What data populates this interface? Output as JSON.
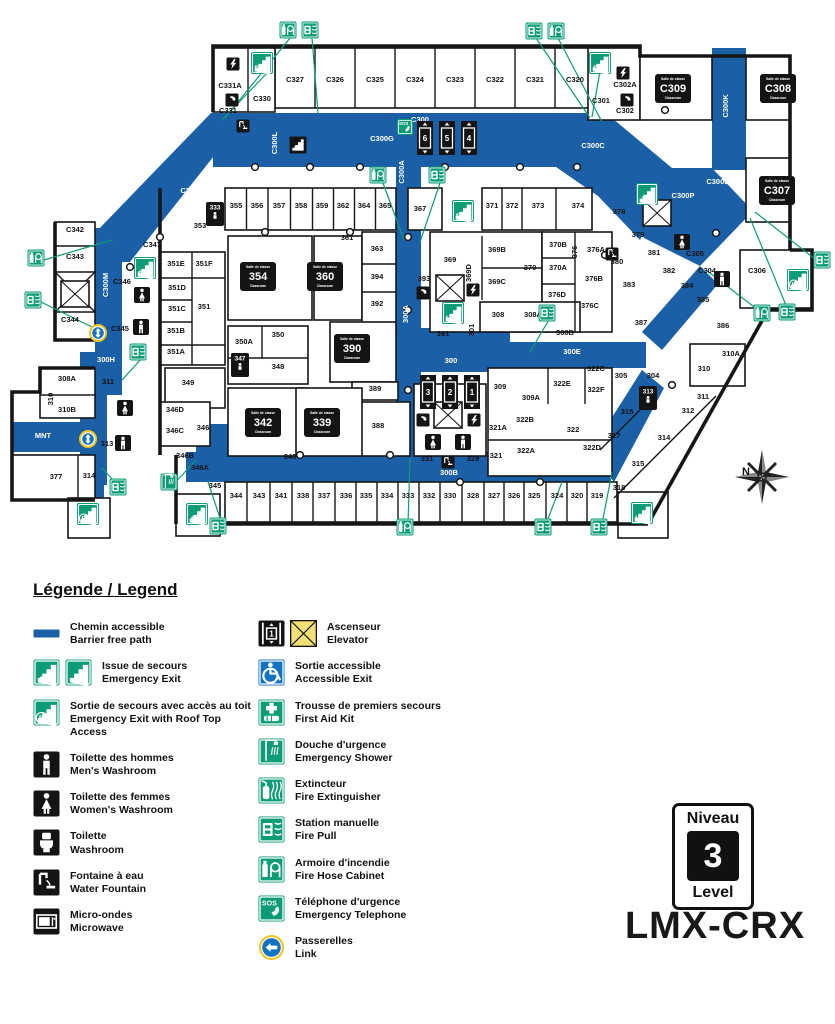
{
  "page": {
    "background": "#ffffff"
  },
  "colors": {
    "path_blue": "#1b5fa6",
    "sign_green": "#0c9c77",
    "sign_black": "#141414",
    "elevator_yellow": "#f3e176",
    "link_ring_yellow": "#f2c31c",
    "accessible_blue": "#1273c0",
    "wall": "#161616"
  },
  "building_code": "LMX-CRX",
  "level_badge": {
    "top": "Niveau",
    "number": "3",
    "bottom": "Level"
  },
  "compass_label": "N",
  "legend": {
    "title": "Légende / Legend",
    "left": [
      {
        "icon": "barrier-path",
        "fr": "Chemin accessible",
        "en": "Barrier free path"
      },
      {
        "icon": "emergency-exit",
        "fr": "Issue de secours",
        "en": "Emergency Exit"
      },
      {
        "icon": "emergency-exit-roof",
        "fr": "Sortie de secours avec accès au toit",
        "en": "Emergency Exit with Roof Top Access"
      },
      {
        "icon": "mens-washroom",
        "fr": "Toilette des hommes",
        "en": "Men's Washroom"
      },
      {
        "icon": "womens-washroom",
        "fr": "Toilette des femmes",
        "en": "Women's Washroom"
      },
      {
        "icon": "washroom",
        "fr": "Toilette",
        "en": "Washroom"
      },
      {
        "icon": "water-fountain",
        "fr": "Fontaine à eau",
        "en": "Water Fountain"
      },
      {
        "icon": "microwave",
        "fr": "Micro-ondes",
        "en": "Microwave"
      }
    ],
    "right": [
      {
        "icon": "elevator",
        "fr": "Ascenseur",
        "en": "Elevator"
      },
      {
        "icon": "accessible-exit",
        "fr": "Sortie accessible",
        "en": "Accessible Exit"
      },
      {
        "icon": "first-aid",
        "fr": "Trousse de premiers secours",
        "en": "First Aid Kit"
      },
      {
        "icon": "emergency-shower",
        "fr": "Douche d'urgence",
        "en": "Emergency Shower"
      },
      {
        "icon": "fire-extinguisher",
        "fr": "Extincteur",
        "en": "Fire Extinguisher"
      },
      {
        "icon": "fire-pull",
        "fr": "Station manuelle",
        "en": "Fire Pull"
      },
      {
        "icon": "fire-hose",
        "fr": "Armoire d'incendie",
        "en": "Fire Hose Cabinet"
      },
      {
        "icon": "emergency-telephone",
        "fr": "Téléphone d'urgence",
        "en": "Emergency Telephone"
      },
      {
        "icon": "link",
        "fr": "Passerelles",
        "en": "Link"
      }
    ]
  },
  "map": {
    "corridor_labels": [
      [
        "C300",
        420,
        122,
        "h"
      ],
      [
        "C300A",
        404,
        172,
        "v"
      ],
      [
        "C300B",
        718,
        184,
        "h"
      ],
      [
        "C300C",
        593,
        148,
        "h"
      ],
      [
        "C300G",
        382,
        141,
        "h"
      ],
      [
        "C300H",
        243,
        178,
        "h"
      ],
      [
        "C300K",
        728,
        106,
        "v"
      ],
      [
        "C300L",
        277,
        143,
        "v"
      ],
      [
        "C300M",
        108,
        285,
        "v"
      ],
      [
        "C300N",
        192,
        193,
        "h"
      ],
      [
        "C300P",
        683,
        198,
        "h"
      ],
      [
        "300A",
        408,
        314,
        "v"
      ],
      [
        "300",
        451,
        363,
        "h"
      ],
      [
        "300B",
        449,
        475,
        "h"
      ],
      [
        "300E",
        572,
        354,
        "h"
      ],
      [
        "300F",
        689,
        334,
        "h"
      ],
      [
        "300G",
        577,
        472,
        "h"
      ],
      [
        "300H",
        106,
        362,
        "h"
      ],
      [
        "300J",
        477,
        208,
        "v"
      ],
      [
        "304A",
        92,
        404,
        "v"
      ],
      [
        "MNT",
        43,
        438,
        "h"
      ]
    ],
    "rooms": [
      [
        "C331A",
        230,
        88
      ],
      [
        "C330",
        262,
        101
      ],
      [
        "C331",
        228,
        113
      ],
      [
        "C327",
        295,
        82
      ],
      [
        "C326",
        335,
        82
      ],
      [
        "C325",
        375,
        82
      ],
      [
        "C324",
        415,
        82
      ],
      [
        "C323",
        455,
        82
      ],
      [
        "C322",
        495,
        82
      ],
      [
        "C321",
        535,
        82
      ],
      [
        "C320",
        575,
        82
      ],
      [
        "C301",
        601,
        103
      ],
      [
        "C302A",
        625,
        87
      ],
      [
        "C302",
        625,
        113
      ],
      [
        "C342",
        75,
        232
      ],
      [
        "C343",
        75,
        259
      ],
      [
        "C344",
        70,
        322
      ],
      [
        "C347",
        152,
        247
      ],
      [
        "C346",
        122,
        284
      ],
      [
        "C345",
        120,
        331
      ],
      [
        "355",
        236,
        208
      ],
      [
        "356",
        257,
        208
      ],
      [
        "357",
        279,
        208
      ],
      [
        "358",
        301,
        208
      ],
      [
        "359",
        322,
        208
      ],
      [
        "362",
        343,
        208
      ],
      [
        "364",
        364,
        208
      ],
      [
        "365",
        385,
        208
      ],
      [
        "353",
        200,
        228
      ],
      [
        "367",
        420,
        211
      ],
      [
        "371",
        492,
        208
      ],
      [
        "372",
        512,
        208
      ],
      [
        "373",
        538,
        208
      ],
      [
        "374",
        578,
        208
      ],
      [
        "351E",
        176,
        266
      ],
      [
        "351F",
        204,
        266
      ],
      [
        "351D",
        177,
        290
      ],
      [
        "351C",
        177,
        311
      ],
      [
        "351B",
        176,
        333
      ],
      [
        "351A",
        176,
        354
      ],
      [
        "351",
        204,
        309
      ],
      [
        "361",
        347,
        240
      ],
      [
        "363",
        377,
        251
      ],
      [
        "394",
        377,
        279
      ],
      [
        "392",
        377,
        306
      ],
      [
        "350A",
        244,
        344
      ],
      [
        "350",
        278,
        337
      ],
      [
        "348",
        278,
        369
      ],
      [
        "349",
        188,
        385
      ],
      [
        "369",
        450,
        262
      ],
      [
        "369B",
        497,
        252
      ],
      [
        "369C",
        497,
        284
      ],
      [
        "369D",
        471,
        273,
        "v"
      ],
      [
        "393",
        424,
        281
      ],
      [
        "370",
        530,
        270
      ],
      [
        "370A",
        558,
        270
      ],
      [
        "370B",
        558,
        247
      ],
      [
        "376",
        577,
        252,
        "v"
      ],
      [
        "376A",
        596,
        252
      ],
      [
        "376B",
        594,
        281
      ],
      [
        "376C",
        590,
        308
      ],
      [
        "376D",
        557,
        297
      ],
      [
        "380",
        617,
        264
      ],
      [
        "378",
        619,
        214
      ],
      [
        "379",
        638,
        237
      ],
      [
        "381",
        654,
        255
      ],
      [
        "382",
        669,
        273
      ],
      [
        "383",
        629,
        287
      ],
      [
        "384",
        687,
        288
      ],
      [
        "385",
        703,
        302
      ],
      [
        "386",
        723,
        328
      ],
      [
        "387",
        641,
        325
      ],
      [
        "C305",
        695,
        256
      ],
      [
        "C304",
        707,
        273
      ],
      [
        "C306",
        757,
        273
      ],
      [
        "391",
        443,
        336
      ],
      [
        "301",
        474,
        330,
        "v"
      ],
      [
        "308",
        498,
        317
      ],
      [
        "308A",
        533,
        317
      ],
      [
        "308B",
        565,
        335
      ],
      [
        "310A",
        731,
        356
      ],
      [
        "310",
        704,
        371
      ],
      [
        "309",
        500,
        389
      ],
      [
        "309A",
        531,
        400
      ],
      [
        "322C",
        596,
        371
      ],
      [
        "322E",
        562,
        386
      ],
      [
        "322F",
        596,
        392
      ],
      [
        "322B",
        525,
        422
      ],
      [
        "321A",
        498,
        430
      ],
      [
        "322",
        573,
        432
      ],
      [
        "322A",
        526,
        453
      ],
      [
        "321",
        496,
        458
      ],
      [
        "322D",
        592,
        450
      ],
      [
        "305",
        621,
        378
      ],
      [
        "304",
        653,
        378
      ],
      [
        "315",
        627,
        414
      ],
      [
        "317",
        614,
        438
      ],
      [
        "315",
        638,
        466
      ],
      [
        "314",
        664,
        440
      ],
      [
        "312",
        688,
        413
      ],
      [
        "311",
        703,
        399
      ],
      [
        "318",
        619,
        490
      ],
      [
        "308A",
        67,
        381
      ],
      [
        "310",
        53,
        399,
        "v"
      ],
      [
        "310B",
        67,
        412
      ],
      [
        "311",
        108,
        384
      ],
      [
        "313",
        107,
        446
      ],
      [
        "314",
        89,
        478
      ],
      [
        "377",
        56,
        479
      ],
      [
        "346D",
        175,
        412
      ],
      [
        "346C",
        175,
        433
      ],
      [
        "346",
        203,
        430
      ],
      [
        "346B",
        185,
        458
      ],
      [
        "346A",
        200,
        470
      ],
      [
        "345",
        215,
        488
      ],
      [
        "340",
        290,
        459
      ],
      [
        "388",
        378,
        428
      ],
      [
        "389",
        375,
        391
      ],
      [
        "331",
        427,
        461
      ],
      [
        "329",
        473,
        461
      ],
      [
        "344",
        236,
        498
      ],
      [
        "343",
        259,
        498
      ],
      [
        "341",
        281,
        498
      ],
      [
        "338",
        303,
        498
      ],
      [
        "337",
        324,
        498
      ],
      [
        "336",
        346,
        498
      ],
      [
        "335",
        366,
        498
      ],
      [
        "334",
        387,
        498
      ],
      [
        "333",
        408,
        498
      ],
      [
        "332",
        429,
        498
      ],
      [
        "330",
        450,
        498
      ],
      [
        "328",
        473,
        498
      ],
      [
        "327",
        494,
        498
      ],
      [
        "326",
        514,
        498
      ],
      [
        "325",
        534,
        498
      ],
      [
        "324",
        557,
        498
      ],
      [
        "320",
        577,
        498
      ],
      [
        "319",
        597,
        498
      ]
    ],
    "classrooms": [
      [
        "C309",
        673,
        88
      ],
      [
        "C308",
        778,
        88
      ],
      [
        "C307",
        777,
        190
      ],
      [
        "354",
        258,
        276
      ],
      [
        "360",
        325,
        276
      ],
      [
        "390",
        352,
        348
      ],
      [
        "342",
        263,
        422
      ],
      [
        "339",
        322,
        422
      ]
    ],
    "classroom_badge_caption_top": "Salle de classe",
    "classroom_badge_caption_bottom": "Classroom",
    "exits": [
      [
        "D",
        262,
        63,
        0
      ],
      [
        "F",
        600,
        63,
        0
      ],
      [
        "E",
        463,
        211,
        0
      ],
      [
        "C",
        145,
        268,
        0
      ],
      [
        "H",
        453,
        313,
        0
      ],
      [
        "J",
        647,
        194,
        0
      ],
      [
        "A",
        197,
        514,
        0
      ],
      [
        "B",
        88,
        514,
        1
      ],
      [
        "K",
        798,
        280,
        1
      ],
      [
        "L",
        642,
        513,
        0
      ]
    ],
    "elevator_banks": [
      {
        "cars": [
          "6",
          "5",
          "4"
        ],
        "x": 425,
        "y": 138
      },
      {
        "cars": [
          "3",
          "2",
          "1"
        ],
        "x": 428,
        "y": 392
      }
    ],
    "icons": [
      [
        "sos",
        405,
        127
      ],
      [
        "bolt",
        233,
        64
      ],
      [
        "tel",
        232,
        100
      ],
      [
        "bolt",
        623,
        73
      ],
      [
        "tel",
        627,
        100
      ],
      [
        "tel",
        423,
        293
      ],
      [
        "bolt",
        473,
        290
      ],
      [
        "tel",
        423,
        420
      ],
      [
        "bolt",
        474,
        420
      ],
      [
        "wc-w",
        142,
        295
      ],
      [
        "wc-m",
        141,
        327
      ],
      [
        "wc-w",
        125,
        408
      ],
      [
        "wc-m",
        123,
        443
      ],
      [
        "wc-w",
        433,
        442
      ],
      [
        "wc-m",
        463,
        442
      ],
      [
        "wc-w",
        682,
        242
      ],
      [
        "wc-m",
        722,
        279
      ],
      [
        "person",
        215,
        214,
        "333"
      ],
      [
        "person",
        240,
        365,
        "347"
      ],
      [
        "person",
        648,
        398,
        "313"
      ],
      [
        "fountain",
        448,
        462
      ],
      [
        "fountain",
        243,
        126
      ],
      [
        "fountain",
        612,
        254
      ],
      [
        "link",
        98,
        333
      ],
      [
        "link",
        88,
        439
      ],
      [
        "hose",
        288,
        30
      ],
      [
        "pull",
        310,
        30
      ],
      [
        "pull",
        534,
        31
      ],
      [
        "hose",
        556,
        31
      ],
      [
        "hose",
        36,
        258
      ],
      [
        "pull",
        33,
        300
      ],
      [
        "hose",
        378,
        175
      ],
      [
        "pull",
        437,
        175
      ],
      [
        "pull",
        138,
        352
      ],
      [
        "pull",
        547,
        313
      ],
      [
        "pull",
        118,
        487
      ],
      [
        "shower",
        169,
        482
      ],
      [
        "pull",
        218,
        526
      ],
      [
        "hose",
        405,
        527
      ],
      [
        "pull",
        543,
        527
      ],
      [
        "pull",
        599,
        527
      ],
      [
        "hose",
        762,
        313
      ],
      [
        "pull",
        787,
        312
      ],
      [
        "pull",
        822,
        260
      ],
      [
        "stair3",
        298,
        145
      ]
    ]
  }
}
